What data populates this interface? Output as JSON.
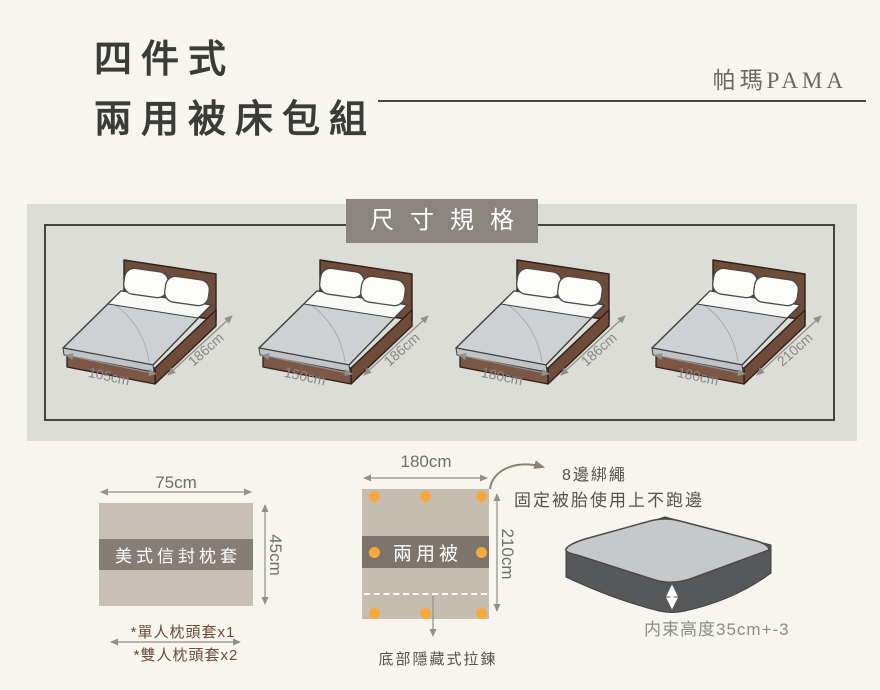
{
  "header": {
    "title_line1": "四件式",
    "title_line2": "兩用被床包組",
    "brand": "帕瑪PAMA"
  },
  "spec": {
    "heading": "尺寸規格",
    "beds": [
      {
        "width": "105cm",
        "length": "186cm"
      },
      {
        "width": "150cm",
        "length": "186cm"
      },
      {
        "width": "180cm",
        "length": "186cm"
      },
      {
        "width": "180cm",
        "length": "210cm"
      }
    ]
  },
  "pillow": {
    "label": "美式信封枕套",
    "width": "75cm",
    "height": "45cm",
    "note1": "*單人枕頭套x1",
    "note2": "*雙人枕頭套x2"
  },
  "quilt": {
    "label": "兩用被",
    "width": "180cm",
    "height": "210cm",
    "tie_title": "8邊綁繩",
    "tie_desc": "固定被胎使用上不跑邊",
    "zipper_note": "底部隱藏式拉鍊"
  },
  "mattress": {
    "height_note": "内束高度35cm+-3"
  },
  "colors": {
    "page_bg": "#f6f5ee",
    "panel_bg": "#dcddd6",
    "heading_bg": "#8b8580",
    "ink": "#3b3b39",
    "brand_gray": "#6b6764",
    "bed_wood": "#7d5745",
    "bed_wood_dark": "#6f4b3a",
    "sheet_gray": "#ced1d3",
    "fabric_beige": "#c9bfb4",
    "fabric_beige2": "#c6bdb0",
    "band_gray": "#867d76",
    "band_gray2": "#7d746c",
    "accent_orange": "#f6a83d",
    "note_brown": "#6d4b37",
    "dim_gray": "#8f8f8c",
    "text_gray": "#55534d"
  }
}
